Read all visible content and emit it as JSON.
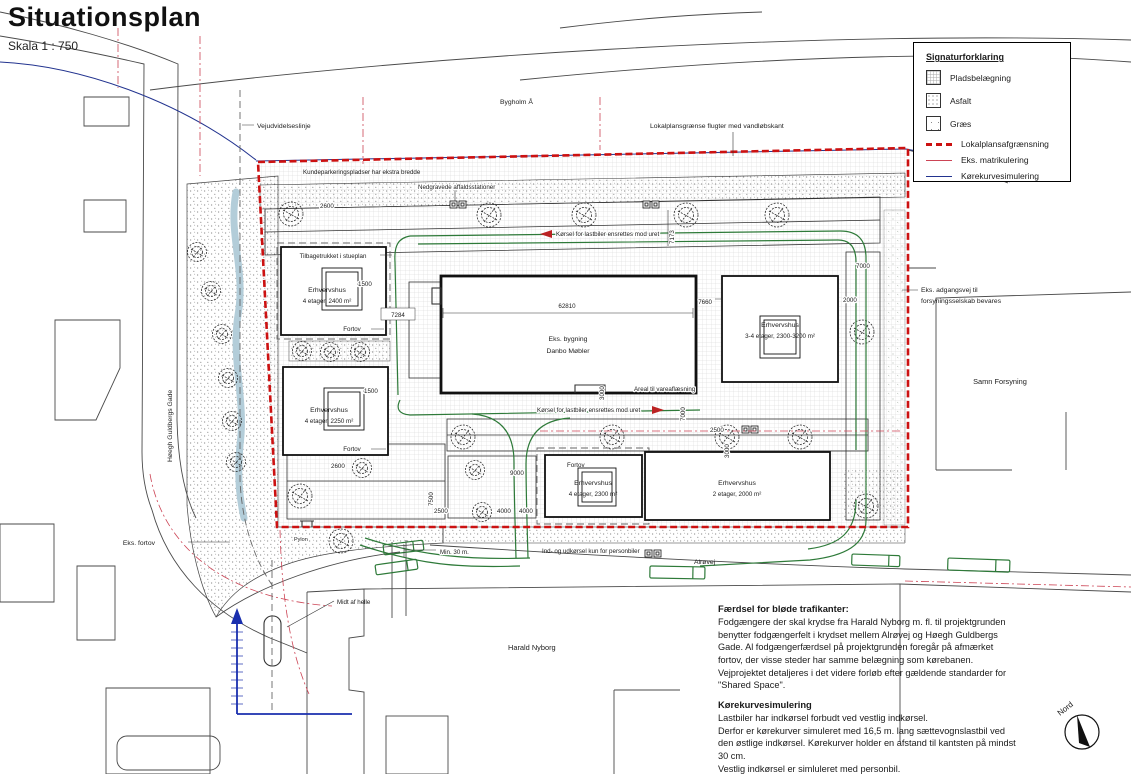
{
  "title": {
    "main": "Situationsplan",
    "scale": "Skala 1 : 750"
  },
  "legend": {
    "title": "Signaturforklaring",
    "items": [
      {
        "label": "Pladsbelægning"
      },
      {
        "label": "Asfalt"
      },
      {
        "label": "Græs"
      },
      {
        "label": "Lokalplansafgrænsning"
      },
      {
        "label": "Eks. matrikulering"
      },
      {
        "label": "Kørekurvesimulering"
      }
    ],
    "colors": {
      "boundary": "#cc1111",
      "matrikel": "#cc4455",
      "curve": "#22338f"
    }
  },
  "compass": {
    "label": "Nord"
  },
  "plan": {
    "water": "Bygholm Å",
    "annotations": {
      "vejudvidelseslinje": "Vejudvidelseslinje",
      "lokalplan_flugter": "Lokalplansgrænse flugter med vandløbskant",
      "kundeparkering": "Kundeparkeringspladser har ekstra bredde",
      "affaldsstationer": "Nedgravede affaldsstationer",
      "lastbil_ensrettet": "Kørsel for lastbiler ensrettes mod uret",
      "vareaflaesning": "Areal til vareaflæsning",
      "adgangsvej_1": "Eks. adgangsvej til",
      "adgangsvej_2": "forsyningsselskab bevares",
      "eks_fortov": "Eks. fortov",
      "pylon": "Pylon",
      "midt_af_helle": "Midt af helle",
      "min_30": "Min. 30 m.",
      "personbiler": "Ind- og udkørsel kun for personbiler",
      "alrovej": "Alrøvej",
      "hoegh_guldbergs_gade": "Høegh Guldbergs Gade",
      "tilbagetrukket": "Tilbagetrukket i stueplan",
      "fortov": "Fortov"
    },
    "buildings": {
      "b1": {
        "name": "Erhvervshus",
        "detail": "4 etager, 2400 m²"
      },
      "b2": {
        "name": "Erhvervshus",
        "detail": "4 etager, 2250 m²"
      },
      "existing": {
        "name": "Eks. bygning",
        "detail": "Danbo Møbler"
      },
      "b3": {
        "name": "Erhvervshus",
        "detail": "3-4 etager, 2300-3200 m²"
      },
      "b4": {
        "name": "Erhvervshus",
        "detail": "4 etager, 2300 m²"
      },
      "b5": {
        "name": "Erhvervshus",
        "detail": "2 etager, 2000 m²"
      },
      "neighbor_south": "Harald Nyborg",
      "neighbor_east": "Samn Forsyning"
    },
    "dimensions": {
      "d62810": "62810",
      "d7284": "7284",
      "d7173": "7173",
      "d7660": "7660",
      "d7000": "7000",
      "d7500": "7500",
      "d9000": "9000",
      "d4000": "4000",
      "d3000": "3000",
      "d2600": "2600",
      "d2500": "2500",
      "d2000": "2000",
      "d1500": "1500"
    }
  },
  "notes": {
    "traffic_heading": "Færdsel for bløde trafikanter:",
    "traffic_body": "Fodgængere der skal krydse fra Harald Nyborg m. fl. til projektgrunden benytter fodgængerfelt i krydset mellem Alrøvej og Høegh Guldbergs Gade. Al fodgængerfærdsel på projektgrunden foregår på afmærket fortov, der visse steder har samme belægning som kørebanen. Vejprojektet detaljeres i det videre forløb efter gældende standarder for \"Shared Space\".",
    "curve_heading": "Kørekurvesimulering",
    "curve_body": "Lastbiler har indkørsel forbudt ved vestlig indkørsel.\nDerfor er kørekurver simuleret med 16,5 m. lang sættevognslastbil ved den østlige indkørsel. Kørekurver holder en afstand til kantsten på mindst 30 cm.\nVestlig indkørsel er simluleret med personbil."
  }
}
